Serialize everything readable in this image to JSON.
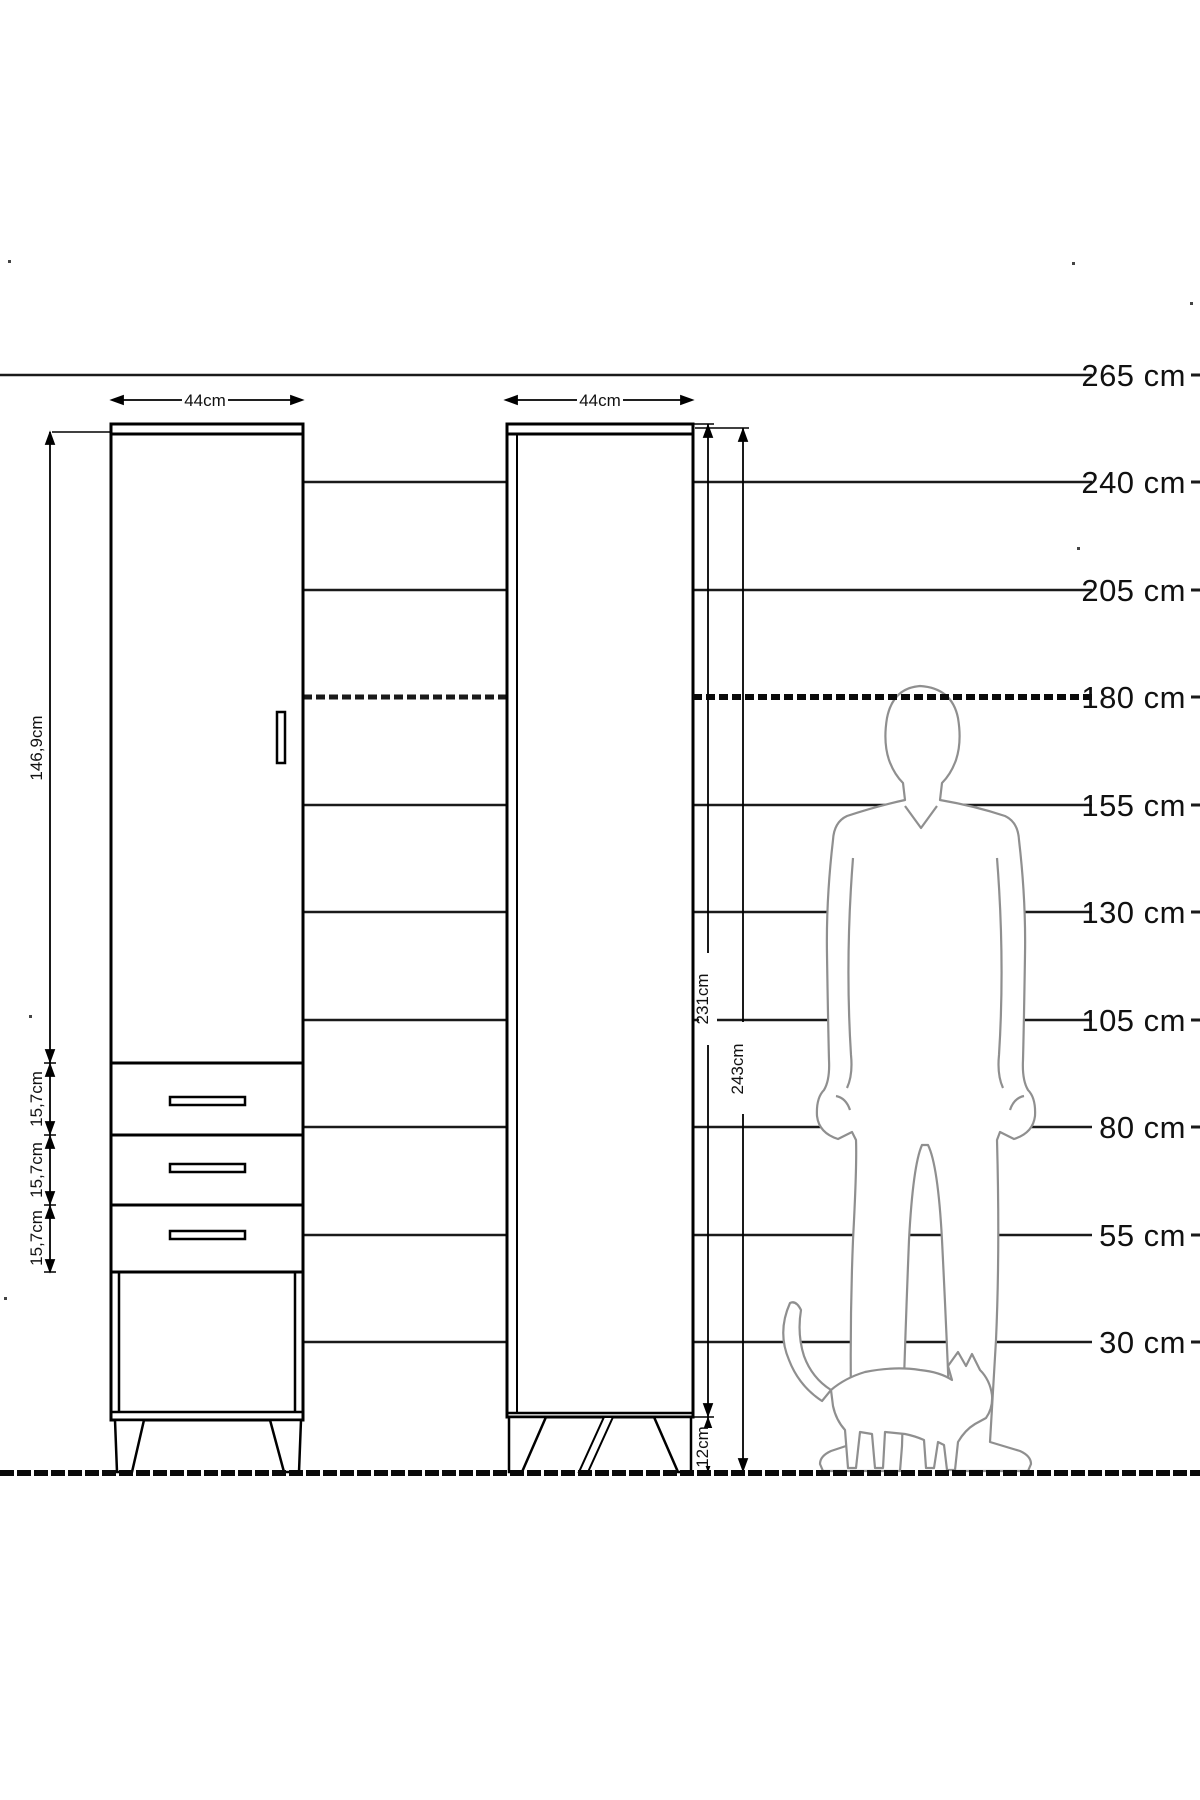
{
  "diagram": {
    "scale_labels": [
      "265 cm",
      "240 cm",
      "205 cm",
      "180 cm",
      "155 cm",
      "130 cm",
      "105 cm",
      "80 cm",
      "55 cm",
      "30 cm"
    ],
    "left_cabinet": {
      "width_label": "44cm",
      "door_height_label": "146,9cm",
      "drawer_labels": [
        "15,7cm",
        "15,7cm",
        "15,7cm"
      ]
    },
    "right_cabinet": {
      "width_label": "44cm",
      "carcass_height_label": "231cm",
      "total_height_label": "243cm",
      "leg_height_label": "12cm"
    },
    "colors": {
      "line": "#000000",
      "figure_outline": "#8f8f8f",
      "text": "#111111",
      "background": "#ffffff"
    }
  }
}
